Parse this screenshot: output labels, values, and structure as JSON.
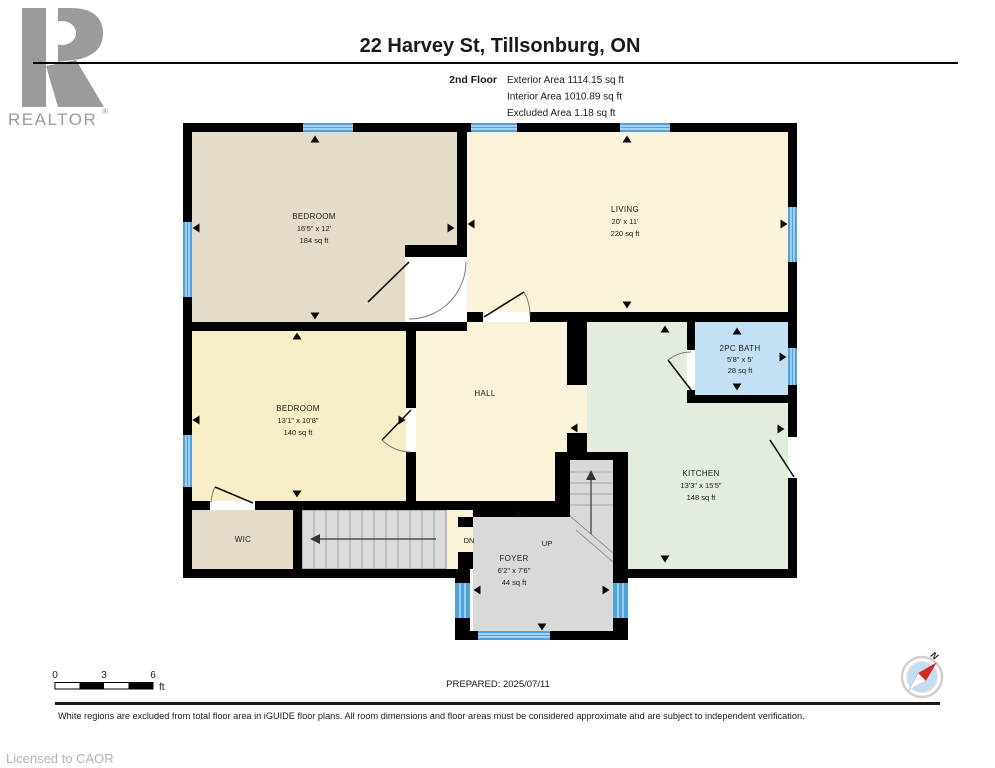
{
  "header": {
    "title": "22 Harvey St, Tillsonburg, ON",
    "floor_label": "2nd Floor",
    "stats": [
      "Exterior Area 1114.15 sq ft",
      "Interior Area 1010.89 sq ft",
      "Excluded Area 1.18 sq ft"
    ]
  },
  "logo": {
    "brand": "REALTOR",
    "registered": "®"
  },
  "rooms": {
    "bedroom1": {
      "name": "BEDROOM",
      "dims": "16'5\" x 12'",
      "area": "184 sq ft"
    },
    "living": {
      "name": "LIVING",
      "dims": "20' x 11'",
      "area": "220 sq ft"
    },
    "bedroom2": {
      "name": "BEDROOM",
      "dims": "13'1\" x 10'8\"",
      "area": "140 sq ft"
    },
    "hall": {
      "name": "HALL"
    },
    "bath": {
      "name": "2PC BATH",
      "dims": "5'8\" x 5'",
      "area": "28 sq ft"
    },
    "kitchen": {
      "name": "KITCHEN",
      "dims": "13'3\" x 15'5\"",
      "area": "148 sq ft"
    },
    "wic": {
      "name": "WIC"
    },
    "foyer": {
      "name": "FOYER",
      "dims": "6'2\" x 7'6\"",
      "area": "44 sq ft"
    },
    "stairs": {
      "down": "DN",
      "up": "UP"
    }
  },
  "scale_bar": {
    "ticks": [
      "0",
      "3",
      "6"
    ],
    "unit": "ft"
  },
  "compass": {
    "north_label": "N"
  },
  "footer": {
    "prepared": "PREPARED: 2025/07/11",
    "disclaimer": "White regions are excluded from total floor area in iGUIDE floor plans. All room dimensions and floor areas must be considered approximate and are subject to independent verification.",
    "licensed": "Licensed to CAOR"
  },
  "colors": {
    "wall": "#000000",
    "window_blue": "#4fa3dc",
    "bath_blue": "#c4e0f5",
    "kitchen_green": "#e2ecdf",
    "bedroom_beige": "#e4dcc9",
    "cream": "#faf3da",
    "bedroom_yellow": "#f8eec7",
    "stair_gray": "#d9d9d9",
    "stair_light": "#dcdcdc",
    "compass_red": "#d42b1e",
    "logo_gray": "#9b9b9b"
  }
}
